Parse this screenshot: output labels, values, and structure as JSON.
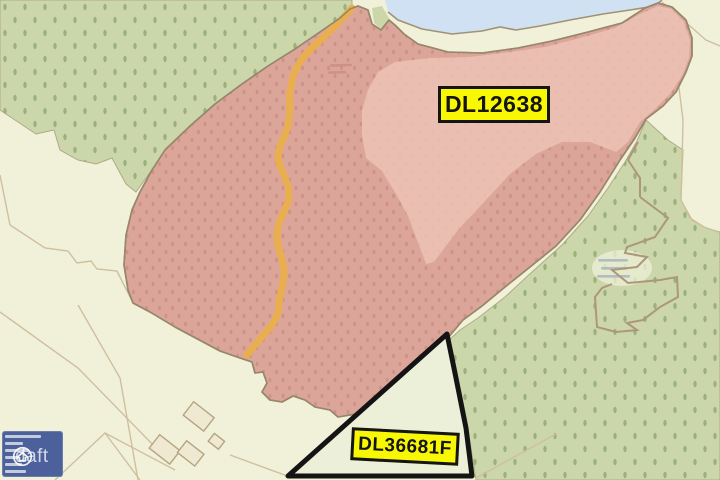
{
  "map": {
    "type": "land-registry-sale-map",
    "parcels": [
      {
        "id": "DL12638",
        "label": "DL12638",
        "style": "pink highlighted folio area",
        "highlight_color": "#dba59a",
        "highlight_color_light": "#ecc2b5"
      },
      {
        "id": "DL36681F",
        "label": "DL36681F",
        "style": "black outlined triangular parcel",
        "outline_color": "#141414",
        "fill_color": "#edf0d8"
      }
    ],
    "label_style": {
      "background": "#f8f704",
      "border": "#141414",
      "text_color": "#141414"
    },
    "watermark": {
      "brand": "daft",
      "icon": "house-icon",
      "color": "rgba(255,255,255,0.75)"
    },
    "legend_panel": {
      "background": "#4c609b",
      "note": "micro-text scale legend, illegible at this resolution"
    },
    "features": {
      "water_color": "#cfe1f2",
      "woodland_color": "#cbd7ab",
      "woodland_dot_color": "#9cb07c",
      "field_color": "#f1f1da",
      "orange_track_color": "#e9ae4e",
      "boundary_line_color": "#cfbf9f",
      "shoreline_line_color": "#a39272"
    }
  }
}
